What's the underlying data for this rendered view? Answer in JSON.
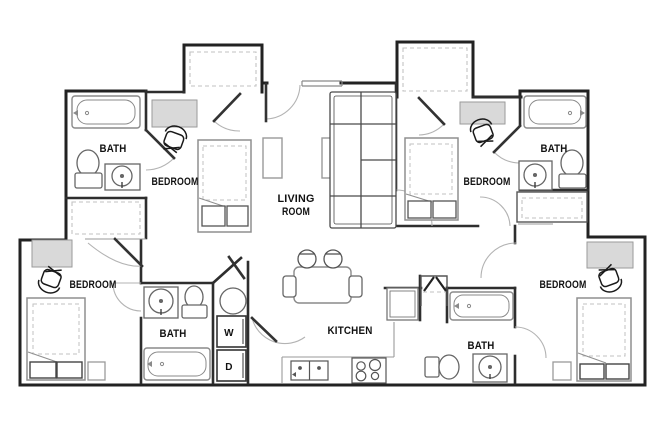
{
  "plan": {
    "type": "apartment-floor-plan",
    "colors": {
      "wall": "#222222",
      "interior_wall": "#2e2e2e",
      "fixture": "#8f8f8f",
      "fixture_dark": "#444444",
      "door_leaf": "#333333",
      "door_arc": "#b3b3b3",
      "closet_dash": "#c2c2c2",
      "desk_fill": "#d9d9d9",
      "label": "#111111",
      "background": "#ffffff"
    },
    "labels": {
      "bath_top_left": "BATH",
      "bedroom_top_left": "BEDROOM",
      "living_line1": "LIVING",
      "living_line2": "ROOM",
      "bedroom_top_right": "BEDROOM",
      "bath_top_right": "BATH",
      "bedroom_bottom_left": "BEDROOM",
      "bath_bottom_left": "BATH",
      "washer": "W",
      "dryer": "D",
      "kitchen": "KITCHEN",
      "bath_bottom_right": "BATH",
      "bedroom_bottom_right": "BEDROOM"
    },
    "fixture_icons": [
      "bathtub-icon",
      "toilet-icon",
      "sink-icon",
      "bed-icon",
      "pillow-icon",
      "desk-icon",
      "desk-chair-icon",
      "sofa-icon",
      "coffee-table-icon",
      "tv-stand-icon",
      "dining-table-icon",
      "stool-icon",
      "dining-chair-icon",
      "refrigerator-icon",
      "range-icon",
      "kitchen-sink-icon",
      "washer-icon",
      "dryer-icon",
      "water-heater-icon",
      "closet-rod-icon",
      "door-swing-icon",
      "window-icon",
      "pantry-icon"
    ]
  }
}
